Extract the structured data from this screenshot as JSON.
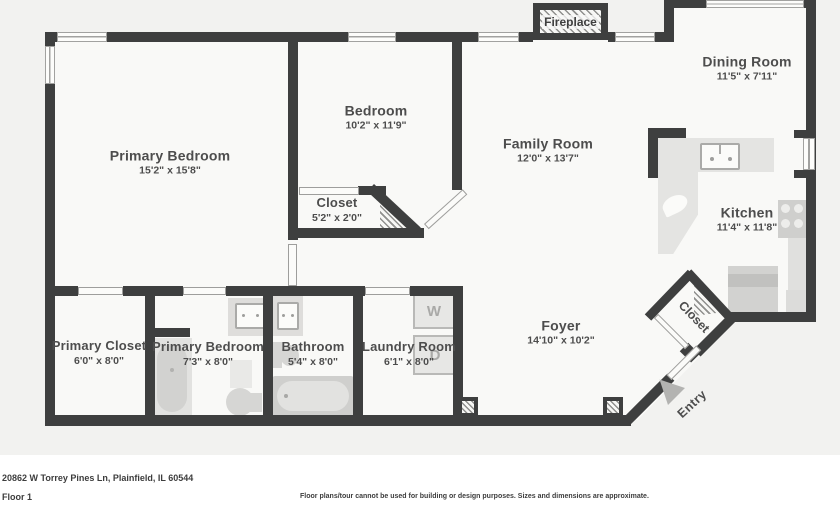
{
  "rooms": {
    "primary_bedroom": {
      "name": "Primary Bedroom",
      "dims": "15'2\" x 15'8\""
    },
    "bedroom": {
      "name": "Bedroom",
      "dims": "10'2\" x 11'9\""
    },
    "bedroom_closet": {
      "name": "Closet",
      "dims": "5'2\" x 2'0\""
    },
    "family_room": {
      "name": "Family Room",
      "dims": "12'0\" x 13'7\""
    },
    "dining_room": {
      "name": "Dining Room",
      "dims": "11'5\" x 7'11\""
    },
    "kitchen": {
      "name": "Kitchen",
      "dims": "11'4\" x 11'8\""
    },
    "foyer": {
      "name": "Foyer",
      "dims": "14'10\" x 10'2\""
    },
    "primary_closet": {
      "name": "Primary Closet",
      "dims": "6'0\" x 8'0\""
    },
    "primary_bedroom_2": {
      "name": "Primary Bedroom",
      "dims": "7'3\" x 8'0\""
    },
    "bathroom": {
      "name": "Bathroom",
      "dims": "5'4\" x 8'0\""
    },
    "laundry_room": {
      "name": "Laundry Room",
      "dims": "6'1\" x 8'0\""
    }
  },
  "features": {
    "fireplace": "Fireplace",
    "entry_closet": "Closet",
    "entry": "Entry",
    "washer": "W",
    "dryer": "D"
  },
  "footer": {
    "address": "20862 W Torrey Pines Ln, Plainfield, IL 60544",
    "floor": "Floor 1",
    "disclaimer": "Floor plans/tour cannot be used for building or design purposes. Sizes and dimensions are approximate."
  },
  "colors": {
    "wall": "#3e3f3f",
    "room_fill": "#f9f9f7",
    "outside_fill": "#f2f2f0",
    "fixture_gray": "#d6d6d4",
    "label_text": "#4d4d4d"
  }
}
